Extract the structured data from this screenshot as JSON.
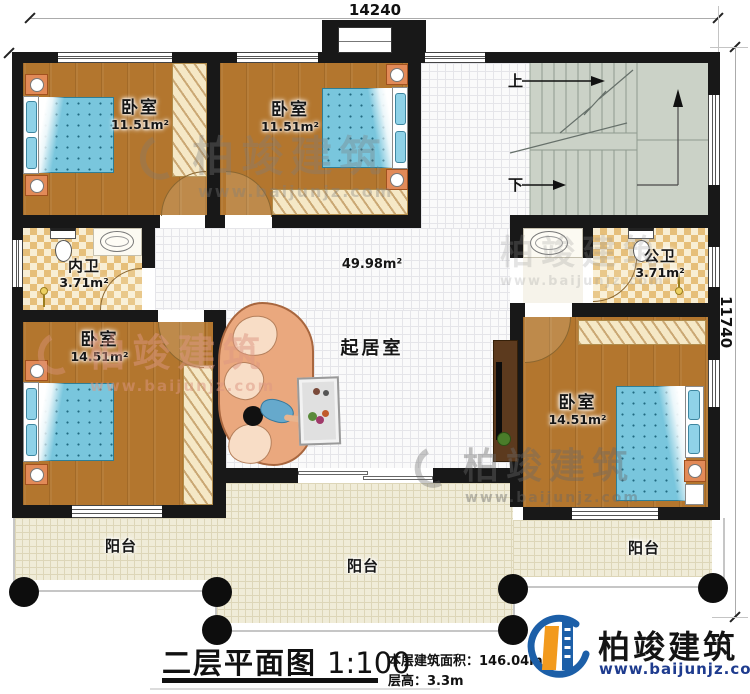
{
  "plan": {
    "dimensions": {
      "top": "14240",
      "right": "11740"
    },
    "rooms": {
      "bedroom1": {
        "name": "卧室",
        "area": "11.51m²"
      },
      "bedroom2": {
        "name": "卧室",
        "area": "11.51m²"
      },
      "bedroom3": {
        "name": "卧室",
        "area": "14.51m²"
      },
      "bedroom4": {
        "name": "卧室",
        "area": "14.51m²"
      },
      "bathInner": {
        "name": "内卫",
        "area": "3.71m²"
      },
      "bathPublic": {
        "name": "公卫",
        "area": "3.71m²"
      },
      "living": {
        "name": "起居室",
        "area": "49.98m²"
      },
      "balcony": {
        "name": "阳台"
      }
    },
    "stairs": {
      "up": "上",
      "down": "下"
    },
    "titleBlock": {
      "title": "二层平面图",
      "scale": "1:100",
      "areaLabel": "本层建筑面积：",
      "areaValue": "146.04m²",
      "heightLabel": "层高：",
      "heightValue": "3.3m"
    }
  },
  "branding": {
    "company": "柏竣建筑",
    "website": "www.baijunjz.com"
  },
  "colors": {
    "wall": "#181818",
    "wood": "#b3762e",
    "whiteTile": "#fafafa",
    "balconyTile": "#f0ecd8",
    "bathChecker": "#e6bf7a",
    "stairs": "#cbd2c7",
    "bedBlue": "#79c6dd",
    "sofa": "#eaa87e",
    "logoBlue": "#1c5fa8",
    "logoOrange": "#f29a1d"
  }
}
